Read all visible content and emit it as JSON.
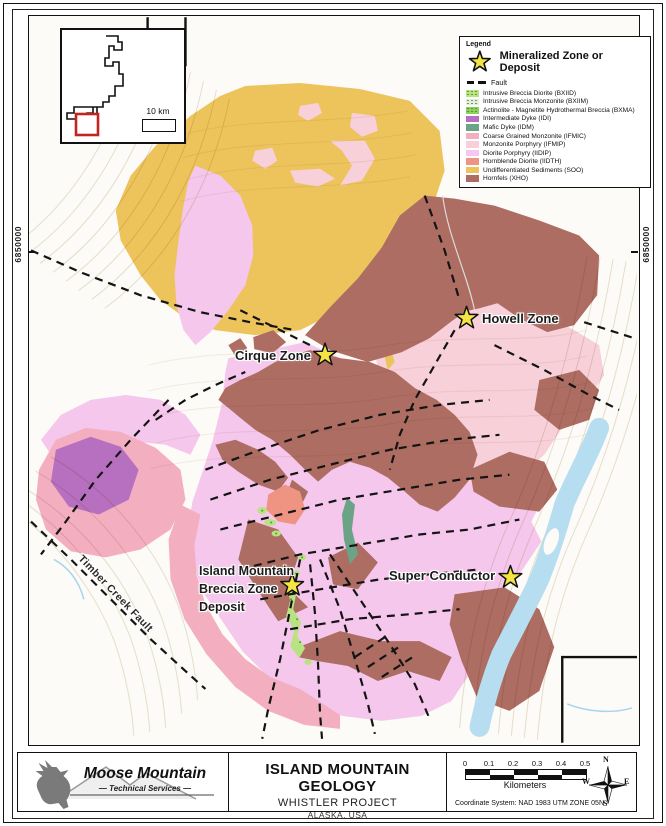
{
  "page": {
    "inset": {
      "scale_label": "10 km"
    },
    "coordinates": {
      "left_label": "6850000",
      "right_label": "6850000"
    },
    "map_labels": {
      "howell": "Howell Zone",
      "cirque": "Cirque Zone",
      "imbz_lines": [
        "Island Mountain",
        "Breccia Zone",
        "Deposit"
      ],
      "super_conductor": "Super Conductor",
      "timber_creek_fault": "Timber Creek Fault"
    },
    "legend": {
      "title": "Legend",
      "star_label": "Mineralized Zone or Deposit",
      "fault_label": "Fault",
      "items": [
        {
          "code": "BXIID",
          "label": "Intrusive Breccia Diorite (BXIID)",
          "color": "#b9e383",
          "pattern": "speckled"
        },
        {
          "code": "BXIIM",
          "label": "Intrusive Breccia Monzonite (BXIIM)",
          "color": "#e6eedd",
          "pattern": "speckled"
        },
        {
          "code": "BXMA",
          "label": "Actinolite - Magnetite Hydrothermal Breccia (BXMA)",
          "color": "#8ed05c",
          "pattern": "speckled"
        },
        {
          "code": "IDI",
          "label": "Intermediate Dyke (IDI)",
          "color": "#b76fc0",
          "pattern": "solid"
        },
        {
          "code": "IDM",
          "label": "Mafic Dyke (IDM)",
          "color": "#6ba387",
          "pattern": "solid"
        },
        {
          "code": "IFMIC",
          "label": "Coarse Grained Monzonite (IFMIC)",
          "color": "#f3afc0",
          "pattern": "solid"
        },
        {
          "code": "IFMIP",
          "label": "Monzonite Porphyry (IFMIP)",
          "color": "#f7d0da",
          "pattern": "solid"
        },
        {
          "code": "IIDIP",
          "label": "Diorite Porphyry (IIDIP)",
          "color": "#f5c7ec",
          "pattern": "solid"
        },
        {
          "code": "IIDTH",
          "label": "Hornblende Diorite (IIDTH)",
          "color": "#ef9382",
          "pattern": "solid"
        },
        {
          "code": "SOO",
          "label": "Undifferentiated Sediments (SOO)",
          "color": "#edc45c",
          "pattern": "solid"
        },
        {
          "code": "XHO",
          "label": "Hornfels (XHO)",
          "color": "#ad6d63",
          "pattern": "solid"
        }
      ]
    },
    "title_block": {
      "logo_line1": "Moose Mountain",
      "logo_line2": "— Technical Services —",
      "title": "ISLAND MOUNTAIN GEOLOGY",
      "subtitle": "WHISTLER PROJECT",
      "location": "ALASKA, USA",
      "scale_ticks": [
        "0",
        "0.1",
        "0.2",
        "0.3",
        "0.4",
        "0.5"
      ],
      "scale_unit": "Kilometers",
      "coordinate_system": "Coordinate System: NAD 1983 UTM ZONE 05N",
      "compass": {
        "n": "N",
        "e": "E",
        "s": "S",
        "w": "W"
      }
    },
    "misc_colors": {
      "river": "#b7ddf1",
      "contour": "#d2bf9b",
      "fault": "#141414",
      "star_fill": "#f4e542"
    }
  }
}
